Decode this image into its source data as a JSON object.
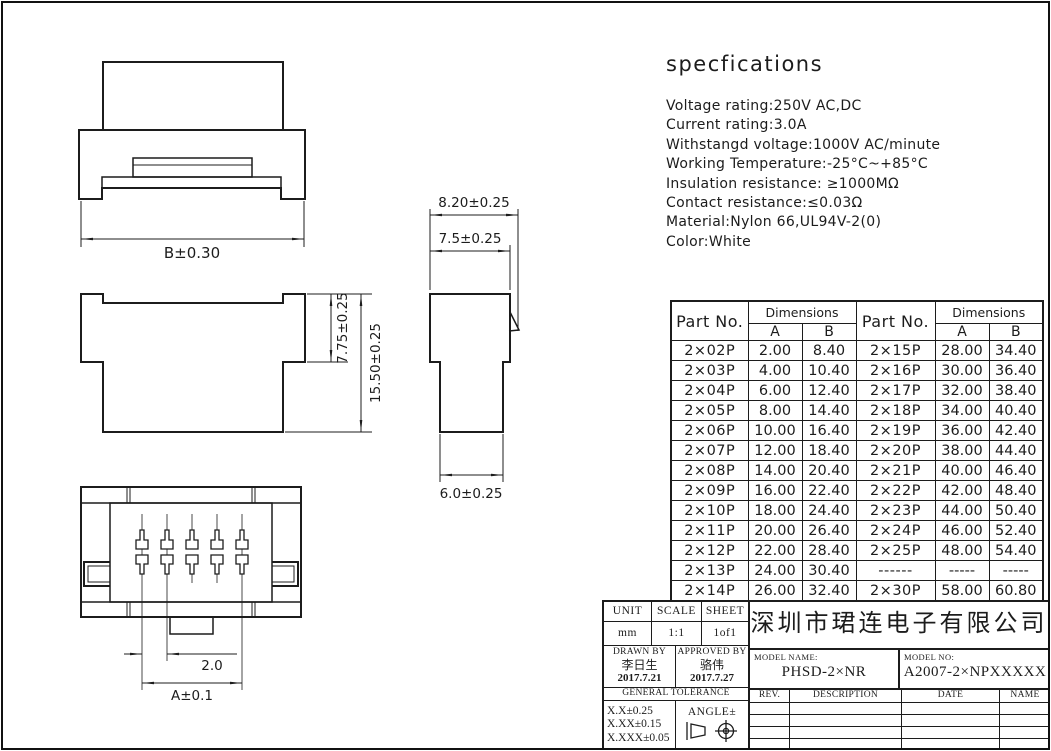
{
  "specifications": {
    "title": "specfications",
    "lines": [
      "Voltage rating:250V AC,DC",
      "Current rating:3.0A",
      "Withstangd voltage:1000V AC/minute",
      "Working Temperature:-25°C~+85°C",
      "Insulation resistance: ≥1000MΩ",
      "Contact resistance:≤0.03Ω",
      "Material:Nylon 66,UL94V-2(0)",
      "Color:White"
    ]
  },
  "drawing": {
    "dim_b": "B±0.30",
    "dim_775": "7.75±0.25",
    "dim_1550": "15.50±0.25",
    "dim_820": "8.20±0.25",
    "dim_75": "7.5±0.25",
    "dim_60": "6.0±0.25",
    "dim_20": "2.0",
    "dim_a": "A±0.1"
  },
  "parts_table": {
    "col_part": "Part No.",
    "col_dim": "Dimensions",
    "col_a": "A",
    "col_b": "B",
    "rows": [
      {
        "p1": "2×02P",
        "a1": "2.00",
        "b1": "8.40",
        "p2": "2×15P",
        "a2": "28.00",
        "b2": "34.40"
      },
      {
        "p1": "2×03P",
        "a1": "4.00",
        "b1": "10.40",
        "p2": "2×16P",
        "a2": "30.00",
        "b2": "36.40"
      },
      {
        "p1": "2×04P",
        "a1": "6.00",
        "b1": "12.40",
        "p2": "2×17P",
        "a2": "32.00",
        "b2": "38.40"
      },
      {
        "p1": "2×05P",
        "a1": "8.00",
        "b1": "14.40",
        "p2": "2×18P",
        "a2": "34.00",
        "b2": "40.40"
      },
      {
        "p1": "2×06P",
        "a1": "10.00",
        "b1": "16.40",
        "p2": "2×19P",
        "a2": "36.00",
        "b2": "42.40"
      },
      {
        "p1": "2×07P",
        "a1": "12.00",
        "b1": "18.40",
        "p2": "2×20P",
        "a2": "38.00",
        "b2": "44.40"
      },
      {
        "p1": "2×08P",
        "a1": "14.00",
        "b1": "20.40",
        "p2": "2×21P",
        "a2": "40.00",
        "b2": "46.40"
      },
      {
        "p1": "2×09P",
        "a1": "16.00",
        "b1": "22.40",
        "p2": "2×22P",
        "a2": "42.00",
        "b2": "48.40"
      },
      {
        "p1": "2×10P",
        "a1": "18.00",
        "b1": "24.40",
        "p2": "2×23P",
        "a2": "44.00",
        "b2": "50.40"
      },
      {
        "p1": "2×11P",
        "a1": "20.00",
        "b1": "26.40",
        "p2": "2×24P",
        "a2": "46.00",
        "b2": "52.40"
      },
      {
        "p1": "2×12P",
        "a1": "22.00",
        "b1": "28.40",
        "p2": "2×25P",
        "a2": "48.00",
        "b2": "54.40"
      },
      {
        "p1": "2×13P",
        "a1": "24.00",
        "b1": "30.40",
        "p2": "------",
        "a2": "-----",
        "b2": "-----"
      },
      {
        "p1": "2×14P",
        "a1": "26.00",
        "b1": "32.40",
        "p2": "2×30P",
        "a2": "58.00",
        "b2": "60.80"
      }
    ]
  },
  "title_block": {
    "unit_label": "UNIT",
    "unit_value": "mm",
    "scale_label": "SCALE",
    "scale_value": "1:1",
    "sheet_label": "SHEET",
    "sheet_value": "1of1",
    "drawn_by_label": "DRAWN BY",
    "drawn_by_name": "李日生",
    "drawn_by_date": "2017.7.21",
    "approved_by_label": "APPROVED BY",
    "approved_by_name": "骆伟",
    "approved_by_date": "2017.7.27",
    "general_tolerance_label": "GENERAL TOLERANCE",
    "tolerances": [
      "X.X±0.25",
      "X.XX±0.15",
      "X.XXX±0.05"
    ],
    "angle_label": "ANGLE±",
    "company": "深圳市珺连电子有限公司",
    "model_name_label": "MODEL NAME:",
    "model_name": "PHSD-2×NR",
    "model_no_label": "MODEL NO:",
    "model_no": "A2007-2×NPXXXXX",
    "rev_label": "REV.",
    "description_label": "DESCRIPTION",
    "date_label": "DATE",
    "name_label": "NAME"
  }
}
